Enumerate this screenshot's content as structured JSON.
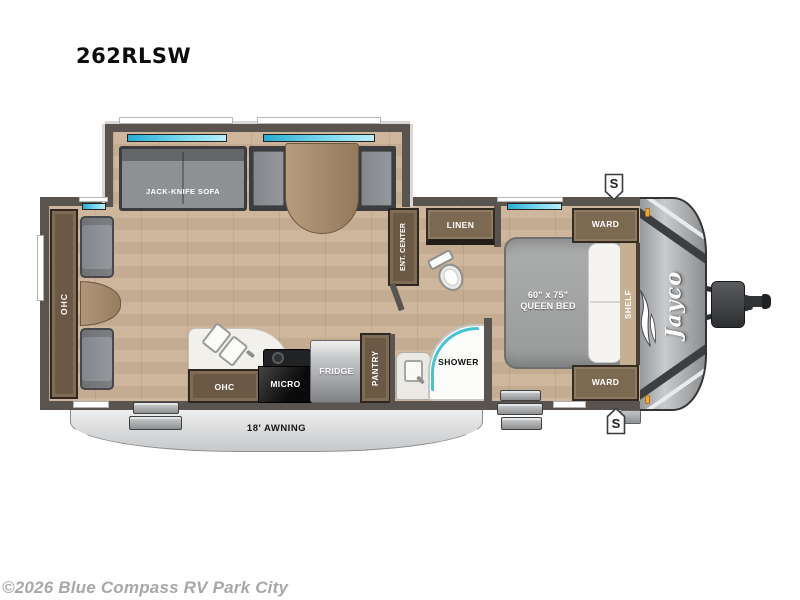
{
  "title": "262RLSW",
  "copyright": "©2026 Blue Compass RV Park City",
  "brand_logo": "Jayco",
  "labels": {
    "sofa": "JACK-KNIFE SOFA",
    "rear_ohc": "OHC",
    "ent_center": "ENT. CENTER",
    "linen": "LINEN",
    "ward_top": "WARD",
    "ward_bottom": "WARD",
    "shelf": "SHELF",
    "bed_size": "60\" x 75\"",
    "bed_type": "QUEEN BED",
    "shower": "SHOWER",
    "pantry": "PANTRY",
    "fridge": "FRIDGE",
    "micro": "MICRO",
    "kitchen_ohc": "OHC",
    "awning": "18' AWNING",
    "speaker_top": "S",
    "speaker_bottom": "S"
  },
  "colors": {
    "wall": "#59544f",
    "floor_wood": "#c9b299",
    "cabinet_wood": "#6b5946",
    "cushion_gray": "#8e9194",
    "window_glass": "#55cde4",
    "awning_gray": "#d7d8d9",
    "front_cap_gray": "#a9abad",
    "marker_light_orange": "#f4a72e",
    "copyright_gray": "#a8a8a8"
  }
}
